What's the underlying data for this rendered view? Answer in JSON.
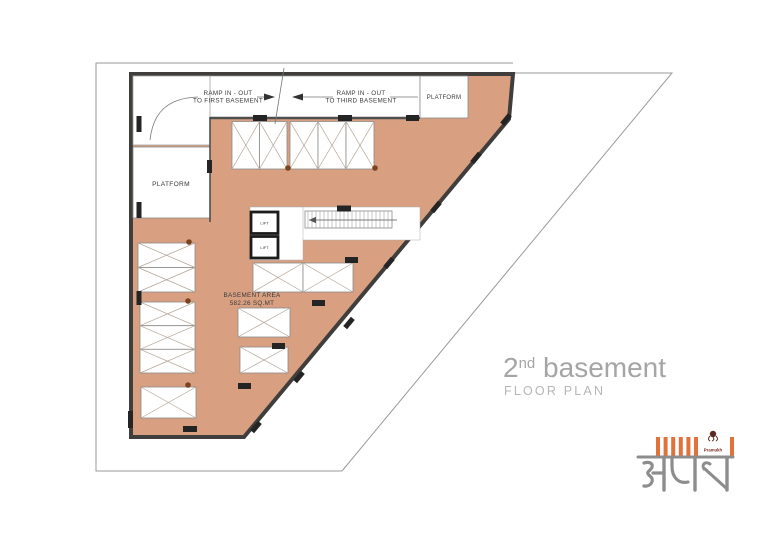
{
  "colors": {
    "plan_fill": "#d8a081",
    "wall": "#3f3e3c",
    "boundary": "#9a9a9a",
    "stall_line": "#b3a598",
    "annotation": "#3a3a3a",
    "title_gray": "#a5a5a5",
    "logo_orange": "#e2713a",
    "logo_maroon": "#7a2a23",
    "wordmark_gray": "#8d8d8d",
    "dot_brown": "#7c431f"
  },
  "plan": {
    "labels": {
      "ramp_first_line1": "RAMP IN - OUT",
      "ramp_first_line2": "TO FIRST BASEMENT",
      "ramp_third_line1": "RAMP IN - OUT",
      "ramp_third_line2": "TO THIRD BASEMENT",
      "platform": "PLATFORM",
      "area_line1": "BASEMENT AREA",
      "area_line2": "582.26 SQ.MT",
      "lift": "LIFT"
    }
  },
  "title": {
    "number": "2",
    "suffix": "nd",
    "name": " basement",
    "subtitle": "FLOOR PLAN"
  },
  "logo": {
    "brand": "Pramukh",
    "wordmark": "अयन"
  }
}
